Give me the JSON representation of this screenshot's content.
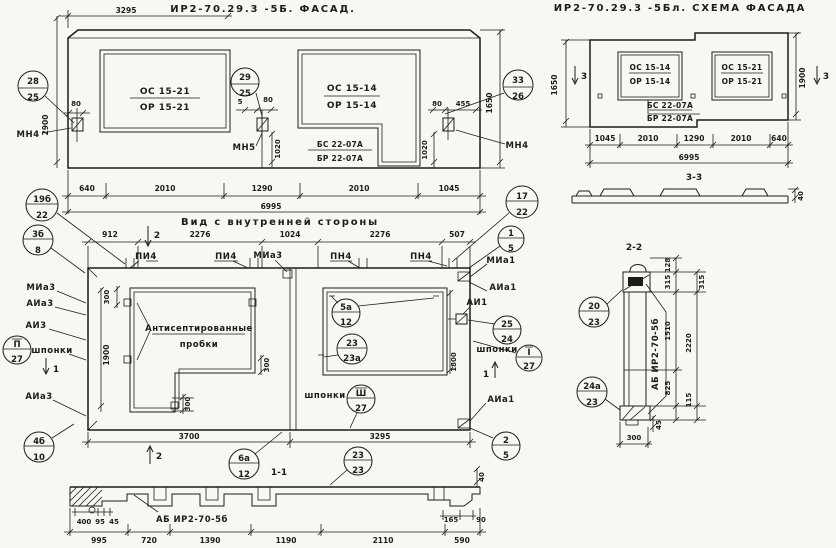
{
  "colors": {
    "ink": "#1e1c18",
    "paper": "#f8f7f3"
  },
  "facade": {
    "dim_top": "3295",
    "title": "ИР2-70.29.3 -5Б. ФАСАД.",
    "height_left": "2900",
    "height_right": "1650",
    "window_left": {
      "top": "ОС 15-21",
      "bottom": "ОР 15-21"
    },
    "window_right": {
      "top": "ОС 15-14",
      "bottom": "ОР 15-14"
    },
    "sill": {
      "top": "БС 22-07А",
      "bottom": "БР 22-07А"
    },
    "callout_left": {
      "top": "28",
      "bottom": "25"
    },
    "callout_mid": {
      "top": "29",
      "bottom": "25"
    },
    "callout_right": {
      "top": "33",
      "bottom": "26"
    },
    "anchor_left_label": "МН4",
    "anchor_mid_label": "МН5",
    "anchor_right_label": "МН4",
    "dim_80a": "80",
    "dim_5": "5",
    "dim_80b": "80",
    "dim_80c": "80",
    "dim_455": "455",
    "dim_1020a": "1020",
    "dim_1020b": "1020",
    "dims_bottom": [
      "640",
      "2010",
      "1290",
      "2010",
      "1045"
    ],
    "dim_total": "6995"
  },
  "scheme": {
    "title": "ИР2-70.29.3 -5Бл. СХЕМА ФАСАДА",
    "height_left": "1650",
    "height_right": "1900",
    "window_left": {
      "top": "ОС 15-14",
      "bottom": "ОР 15-14"
    },
    "window_right": {
      "top": "ОС 15-21",
      "bottom": "ОР 15-21"
    },
    "sill": {
      "top": "БС 22-07А",
      "bottom": "БР 22-07А"
    },
    "section_mark": "3",
    "dims_bottom": [
      "1045",
      "2010",
      "1290",
      "2010",
      "640"
    ],
    "dim_total": "6995"
  },
  "section33": {
    "title": "3-3",
    "dim_40": "40"
  },
  "inner": {
    "title": "Вид с внутренней стороны",
    "dims_top": [
      "912",
      "2276",
      "1024",
      "2276",
      "507"
    ],
    "section2": "2",
    "section1": "1",
    "top_labels": [
      "ПИ4",
      "ПИ4",
      "МИа3",
      "ПН4",
      "ПН4",
      "МИа1"
    ],
    "left_labels": [
      "МИа3",
      "АИа3",
      "АИ3",
      "АИа3"
    ],
    "right_labels": [
      "МИа1",
      "АИа1",
      "АИ1",
      "АИа1"
    ],
    "shponki": "шпонки",
    "note_line1": "Антисептированные",
    "note_line2": "пробки",
    "dim_300a": "300",
    "dim_300b": "300",
    "dim_300c": "300",
    "dim_1900": "1900",
    "dim_1800": "1800",
    "callout_19b": {
      "top": "19б",
      "bottom": "22"
    },
    "callout_3b": {
      "top": "3б",
      "bottom": "8"
    },
    "callout_17": {
      "top": "17",
      "bottom": "22"
    },
    "callout_1": {
      "top": "1",
      "bottom": "5"
    },
    "callout_2": {
      "top": "2",
      "bottom": "5"
    },
    "callout_4b": {
      "top": "4б",
      "bottom": "10"
    },
    "callout_5a": {
      "top": "5а",
      "bottom": "12"
    },
    "callout_23a": {
      "top": "23",
      "bottom": "23а"
    },
    "callout_25": {
      "top": "25",
      "bottom": "24"
    },
    "callout_6a": {
      "top": "6а",
      "bottom": "12"
    },
    "callout_23": {
      "top": "23",
      "bottom": "23"
    },
    "callout_rom1": {
      "top": "I",
      "bottom": "27"
    },
    "callout_rom2": {
      "top": "П",
      "bottom": "27"
    },
    "callout_rom3": {
      "top": "Ш",
      "bottom": "27"
    },
    "dims_bottom": [
      "3700",
      "3295"
    ],
    "section11_title": "1-1"
  },
  "section11": {
    "label": "АБ ИР2-70-5б",
    "dims_small": [
      "400",
      "95",
      "45"
    ],
    "dims_bottom": [
      "995",
      "720",
      "1390",
      "1190",
      "2110",
      "590"
    ],
    "dim_165": "165",
    "dim_90": "90",
    "dim_40": "40"
  },
  "section22": {
    "title": "2-2",
    "label": "АБ ИР2-70-5б",
    "callout_20": {
      "top": "20",
      "bottom": "23"
    },
    "callout_24a": {
      "top": "24а",
      "bottom": "23"
    },
    "dim_128": "128",
    "dim_315a": "315",
    "dim_315b": "315",
    "dim_1510": "1510",
    "dim_2220": "2220",
    "dim_825": "825",
    "dim_115": "115",
    "dim_45": "45",
    "dim_300": "300"
  }
}
